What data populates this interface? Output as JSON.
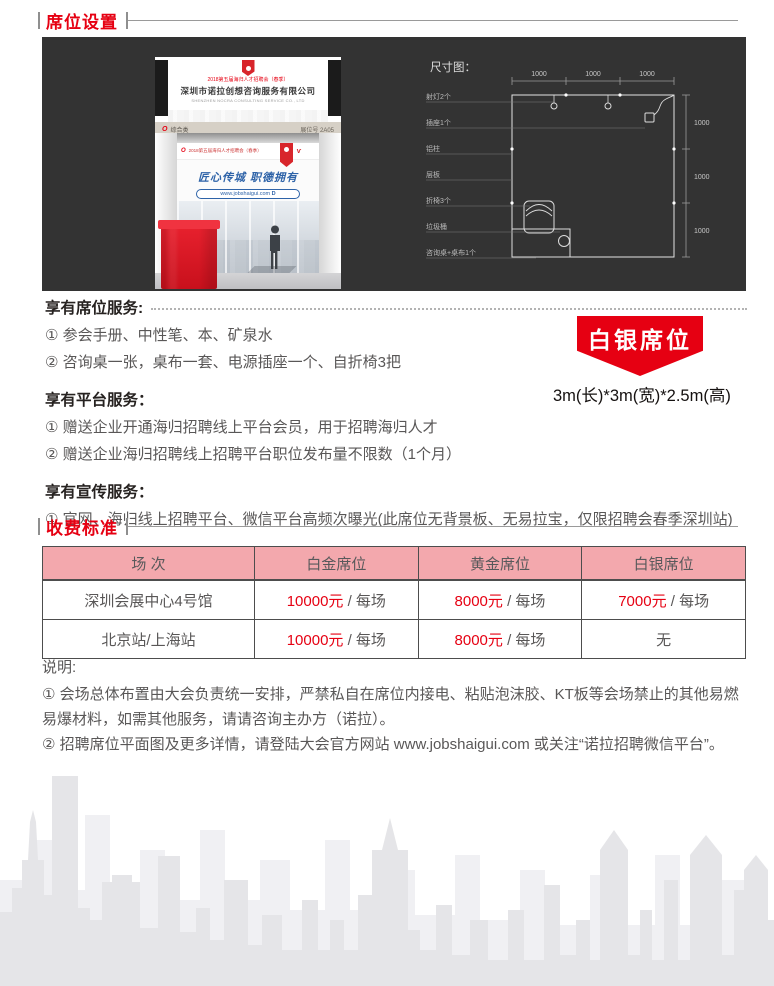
{
  "colors": {
    "accent": "#e60012",
    "panel_bg": "#333333",
    "table_header_bg": "#f3a8ad"
  },
  "header": {
    "seat_setup": "席位设置",
    "pricing": "收费标准"
  },
  "booth": {
    "event_line": "2018第五届海归人才招聘会（春季）",
    "company_cn": "深圳市诺拉创想咨询服务有限公司",
    "company_en": "SHENZHEN NOCRA CONSULTING SERVICE CO., LTD",
    "category": "综合类",
    "booth_no": "展位号 2A05",
    "slogan": "匠心传城 职德拥有",
    "website": "www.jobshaigui.com",
    "website_suffix": "D"
  },
  "diagram": {
    "title": "尺寸图：",
    "top_dims": [
      "1000",
      "1000",
      "1000"
    ],
    "right_dims": [
      "1000",
      "1000",
      "1000"
    ],
    "labels": [
      "射灯2个",
      "插座1个",
      "铝柱",
      "层板",
      "折椅3个",
      "垃圾桶",
      "咨询桌+桌布1个"
    ]
  },
  "services": {
    "seat": {
      "heading": "享有席位服务:",
      "items": [
        "① 参会手册、中性笔、本、矿泉水",
        "② 咨询桌一张，桌布一套、电源插座一个、自折椅3把"
      ]
    },
    "platform": {
      "heading": "享有平台服务：",
      "items": [
        "① 赠送企业开通海归招聘线上平台会员，用于招聘海归人才",
        "② 赠送企业海归招聘线上招聘平台职位发布量不限数（1个月）"
      ]
    },
    "promo": {
      "heading": "享有宣传服务：",
      "items": [
        "① 官网、海归线上招聘平台、微信平台高频次曝光(此席位无背景板、无易拉宝，仅限招聘会春季深圳站)"
      ]
    }
  },
  "badge": {
    "label": "白银席位",
    "size": "3m(长)*3m(宽)*2.5m(高)"
  },
  "pricing": {
    "headers": [
      "场 次",
      "白金席位",
      "黄金席位",
      "白银席位"
    ],
    "rows": [
      {
        "venue": "深圳会展中心4号馆",
        "cells": [
          {
            "price": "10000元",
            "unit": " / 每场"
          },
          {
            "price": "8000元",
            "unit": " / 每场"
          },
          {
            "price": "7000元",
            "unit": " / 每场"
          }
        ]
      },
      {
        "venue": "北京站/上海站",
        "cells": [
          {
            "price": "10000元",
            "unit": " / 每场"
          },
          {
            "price": "8000元",
            "unit": " / 每场"
          },
          {
            "price": "",
            "unit": "无"
          }
        ]
      }
    ]
  },
  "notes": {
    "heading": "说明:",
    "note1": "① 会场总体布置由大会负责统一安排，严禁私自在席位内接电、粘贴泡沫胶、KT板等会场禁止的其他易燃易爆材料，如需其他服务，请请咨询主办方（诺拉）。",
    "note2_prefix": "② 招聘席位平面图及更多详情，请登陆大会官方网站 ",
    "note2_url": "www.jobshaigui.com",
    "note2_suffix": " 或关注“诺拉招聘微信平台”。"
  }
}
